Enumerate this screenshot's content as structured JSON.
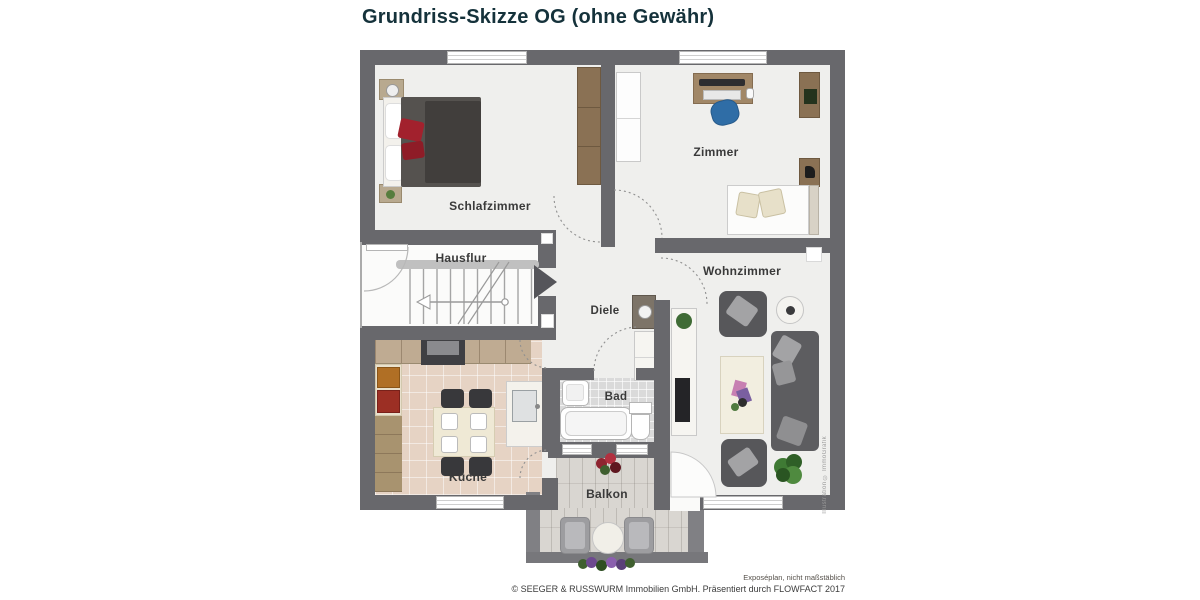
{
  "title": "Grundriss-Skizze OG (ohne Gewähr)",
  "floorplan": {
    "rooms": [
      {
        "label": "Schlafzimmer"
      },
      {
        "label": "Zimmer"
      },
      {
        "label": "Hausflur"
      },
      {
        "label": "Diele"
      },
      {
        "label": "Wohnzimmer"
      },
      {
        "label": "Bad"
      },
      {
        "label": "Küche"
      },
      {
        "label": "Balkon"
      }
    ],
    "watermark": "Illustration © ImmoGrafik",
    "colors": {
      "wall": "#68686c",
      "floor": "#efefed",
      "kitchen_floor": "#e6d3c4",
      "bath_floor": "#dadada",
      "balcony_deck": "#d9d6d1",
      "wood": "#8a7154",
      "bed_duvet": "#55524f",
      "accent_red": "#a2212d",
      "sofa": "#5d5d60",
      "chair_blue": "#2f6da6",
      "title_text": "#15323b"
    }
  },
  "footer": {
    "note": "Exposéplan, nicht maßstäblich",
    "copyright": "© SEEGER & RUSSWURM Immobilien GmbH. Präsentiert durch FLOWFACT 2017"
  }
}
